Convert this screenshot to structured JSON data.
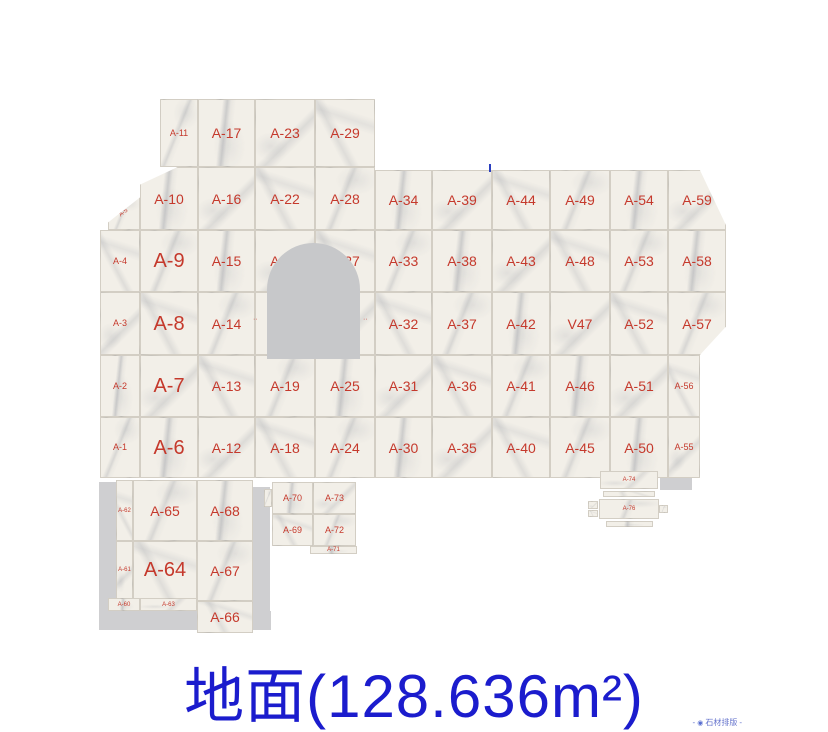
{
  "title": {
    "text": "地面(128.636m²)",
    "color": "#1b1ccd"
  },
  "watermark": {
    "dash_left": "-",
    "logo_icon": "◉",
    "text": "石材排版",
    "dash_right": "-"
  },
  "colors": {
    "label_red": "#c5392c",
    "title_blue": "#1b1ccd",
    "tile_base": "#f2efe8",
    "arch_gray": "#c7c8ca",
    "shadow_gray": "#cfcfd1"
  },
  "plan": {
    "tiles": [
      {
        "label": "A-11",
        "x": 160,
        "y": 99,
        "w": 38,
        "h": 68,
        "size": "sm"
      },
      {
        "label": "A-17",
        "x": 198,
        "y": 99,
        "w": 57,
        "h": 68
      },
      {
        "label": "A-23",
        "x": 255,
        "y": 99,
        "w": 60,
        "h": 68
      },
      {
        "label": "A-29",
        "x": 315,
        "y": 99,
        "w": 60,
        "h": 68
      },
      {
        "label": "A-5",
        "x": 108,
        "y": 196,
        "w": 32,
        "h": 34,
        "size": "xs",
        "rot": -38,
        "clip": "polygon(100% 4%,100% 100%,0 100%,0 78%)"
      },
      {
        "label": "A-10",
        "x": 140,
        "y": 167,
        "w": 58,
        "h": 63,
        "clip": "polygon(65% 0,100% 0,100% 100%,0 100%,0 28%)"
      },
      {
        "label": "A-16",
        "x": 198,
        "y": 167,
        "w": 57,
        "h": 63
      },
      {
        "label": "A-22",
        "x": 255,
        "y": 167,
        "w": 60,
        "h": 63
      },
      {
        "label": "A-28",
        "x": 315,
        "y": 167,
        "w": 60,
        "h": 63
      },
      {
        "label": "A-34",
        "x": 375,
        "y": 170,
        "w": 57,
        "h": 60
      },
      {
        "label": "A-39",
        "x": 432,
        "y": 170,
        "w": 60,
        "h": 60
      },
      {
        "label": "A-44",
        "x": 492,
        "y": 170,
        "w": 58,
        "h": 60
      },
      {
        "label": "A-49",
        "x": 550,
        "y": 170,
        "w": 60,
        "h": 60
      },
      {
        "label": "A-54",
        "x": 610,
        "y": 170,
        "w": 58,
        "h": 60
      },
      {
        "label": "A-59",
        "x": 668,
        "y": 170,
        "w": 58,
        "h": 60,
        "clip": "polygon(0 0,55% 0,100% 92%,100% 100%,0 100%)"
      },
      {
        "label": "A-4",
        "x": 100,
        "y": 230,
        "w": 40,
        "h": 62,
        "size": "sm"
      },
      {
        "label": "A-9",
        "x": 140,
        "y": 230,
        "w": 58,
        "h": 62,
        "size": "lg"
      },
      {
        "label": "A-15",
        "x": 198,
        "y": 230,
        "w": 57,
        "h": 62
      },
      {
        "label": "A-21",
        "x": 255,
        "y": 230,
        "w": 60,
        "h": 62
      },
      {
        "label": "A-27",
        "x": 315,
        "y": 230,
        "w": 60,
        "h": 62
      },
      {
        "label": "A-33",
        "x": 375,
        "y": 230,
        "w": 57,
        "h": 62
      },
      {
        "label": "A-38",
        "x": 432,
        "y": 230,
        "w": 60,
        "h": 62
      },
      {
        "label": "A-43",
        "x": 492,
        "y": 230,
        "w": 58,
        "h": 62
      },
      {
        "label": "A-48",
        "x": 550,
        "y": 230,
        "w": 60,
        "h": 62
      },
      {
        "label": "A-53",
        "x": 610,
        "y": 230,
        "w": 58,
        "h": 62
      },
      {
        "label": "A-58",
        "x": 668,
        "y": 230,
        "w": 58,
        "h": 62
      },
      {
        "label": "A-3",
        "x": 100,
        "y": 292,
        "w": 40,
        "h": 63,
        "size": "sm"
      },
      {
        "label": "A-8",
        "x": 140,
        "y": 292,
        "w": 58,
        "h": 63,
        "size": "lg"
      },
      {
        "label": "A-14",
        "x": 198,
        "y": 292,
        "w": 57,
        "h": 63
      },
      {
        "x": 255,
        "y": 292,
        "w": 60,
        "h": 63
      },
      {
        "x": 315,
        "y": 292,
        "w": 60,
        "h": 63
      },
      {
        "label": "A-32",
        "x": 375,
        "y": 292,
        "w": 57,
        "h": 63
      },
      {
        "label": "A-37",
        "x": 432,
        "y": 292,
        "w": 60,
        "h": 63
      },
      {
        "label": "A-42",
        "x": 492,
        "y": 292,
        "w": 58,
        "h": 63
      },
      {
        "label": "V47",
        "x": 550,
        "y": 292,
        "w": 60,
        "h": 63
      },
      {
        "label": "A-52",
        "x": 610,
        "y": 292,
        "w": 58,
        "h": 63
      },
      {
        "label": "A-57",
        "x": 668,
        "y": 292,
        "w": 58,
        "h": 63,
        "clip": "polygon(0 0,100% 0,100% 55%,55% 100%,0 100%)"
      },
      {
        "label": "A-2",
        "x": 100,
        "y": 355,
        "w": 40,
        "h": 62,
        "size": "sm"
      },
      {
        "label": "A-7",
        "x": 140,
        "y": 355,
        "w": 58,
        "h": 62,
        "size": "lg"
      },
      {
        "label": "A-13",
        "x": 198,
        "y": 355,
        "w": 57,
        "h": 62
      },
      {
        "label": "A-19",
        "x": 255,
        "y": 355,
        "w": 60,
        "h": 62
      },
      {
        "label": "A-25",
        "x": 315,
        "y": 355,
        "w": 60,
        "h": 62
      },
      {
        "label": "A-31",
        "x": 375,
        "y": 355,
        "w": 57,
        "h": 62
      },
      {
        "label": "A-36",
        "x": 432,
        "y": 355,
        "w": 60,
        "h": 62
      },
      {
        "label": "A-41",
        "x": 492,
        "y": 355,
        "w": 58,
        "h": 62
      },
      {
        "label": "A-46",
        "x": 550,
        "y": 355,
        "w": 60,
        "h": 62
      },
      {
        "label": "A-51",
        "x": 610,
        "y": 355,
        "w": 58,
        "h": 62
      },
      {
        "label": "A-56",
        "x": 668,
        "y": 355,
        "w": 32,
        "h": 62,
        "size": "sm"
      },
      {
        "label": "A-1",
        "x": 100,
        "y": 417,
        "w": 40,
        "h": 61,
        "size": "sm"
      },
      {
        "label": "A-6",
        "x": 140,
        "y": 417,
        "w": 58,
        "h": 61,
        "size": "lg"
      },
      {
        "label": "A-12",
        "x": 198,
        "y": 417,
        "w": 57,
        "h": 61
      },
      {
        "label": "A-18",
        "x": 255,
        "y": 417,
        "w": 60,
        "h": 61
      },
      {
        "label": "A-24",
        "x": 315,
        "y": 417,
        "w": 60,
        "h": 61
      },
      {
        "label": "A-30",
        "x": 375,
        "y": 417,
        "w": 57,
        "h": 61
      },
      {
        "label": "A-35",
        "x": 432,
        "y": 417,
        "w": 60,
        "h": 61
      },
      {
        "label": "A-40",
        "x": 492,
        "y": 417,
        "w": 58,
        "h": 61
      },
      {
        "label": "A-45",
        "x": 550,
        "y": 417,
        "w": 60,
        "h": 61
      },
      {
        "label": "A-50",
        "x": 610,
        "y": 417,
        "w": 58,
        "h": 61
      },
      {
        "label": "A-55",
        "x": 668,
        "y": 417,
        "w": 32,
        "h": 61,
        "size": "sm"
      },
      {
        "label": "A-62",
        "x": 116,
        "y": 480,
        "w": 17,
        "h": 61,
        "size": "xs"
      },
      {
        "label": "A-65",
        "x": 133,
        "y": 480,
        "w": 64,
        "h": 61
      },
      {
        "label": "A-68",
        "x": 197,
        "y": 480,
        "w": 56,
        "h": 61
      },
      {
        "label": "A-61",
        "x": 116,
        "y": 541,
        "w": 17,
        "h": 58,
        "size": "xs"
      },
      {
        "label": "A-64",
        "x": 133,
        "y": 541,
        "w": 64,
        "h": 58,
        "size": "lg"
      },
      {
        "label": "A-67",
        "x": 197,
        "y": 541,
        "w": 56,
        "h": 60
      },
      {
        "label": "A-60",
        "x": 108,
        "y": 598,
        "w": 32,
        "h": 13,
        "size": "xs"
      },
      {
        "label": "A-63",
        "x": 140,
        "y": 598,
        "w": 57,
        "h": 13,
        "size": "xs"
      },
      {
        "label": "A-66",
        "x": 197,
        "y": 601,
        "w": 56,
        "h": 32
      },
      {
        "x": 264,
        "y": 489,
        "w": 8,
        "h": 18
      },
      {
        "label": "A-70",
        "x": 272,
        "y": 482,
        "w": 41,
        "h": 32,
        "size": "sm"
      },
      {
        "label": "A-73",
        "x": 313,
        "y": 482,
        "w": 43,
        "h": 32,
        "size": "sm"
      },
      {
        "label": "A-69",
        "x": 272,
        "y": 514,
        "w": 41,
        "h": 32,
        "size": "sm"
      },
      {
        "label": "A-72",
        "x": 313,
        "y": 514,
        "w": 43,
        "h": 32,
        "size": "sm"
      },
      {
        "label": "A-71",
        "x": 310,
        "y": 546,
        "w": 47,
        "h": 8,
        "size": "xs"
      },
      {
        "label": "A-74",
        "x": 600,
        "y": 471,
        "w": 58,
        "h": 18,
        "size": "xs"
      },
      {
        "x": 603,
        "y": 491,
        "w": 52,
        "h": 6
      },
      {
        "label": "A-76",
        "x": 599,
        "y": 499,
        "w": 60,
        "h": 20,
        "size": "xs"
      },
      {
        "x": 606,
        "y": 521,
        "w": 47,
        "h": 6
      },
      {
        "x": 588,
        "y": 501,
        "w": 10,
        "h": 8
      },
      {
        "x": 588,
        "y": 510,
        "w": 10,
        "h": 7
      },
      {
        "x": 659,
        "y": 505,
        "w": 9,
        "h": 8
      }
    ],
    "shadows": [
      {
        "x": 99,
        "y": 482,
        "w": 17,
        "h": 148
      },
      {
        "x": 99,
        "y": 611,
        "w": 172,
        "h": 19
      },
      {
        "x": 253,
        "y": 487,
        "w": 17,
        "h": 131
      },
      {
        "x": 660,
        "y": 469,
        "w": 32,
        "h": 21
      }
    ],
    "arch_cutout": {
      "x": 267,
      "y": 243,
      "w": 93,
      "h": 116
    },
    "partial_marks": [
      {
        "text": "··",
        "x": 253,
        "y": 316
      },
      {
        "text": "··",
        "x": 363,
        "y": 316
      }
    ],
    "blue_tick": {
      "x": 489,
      "y": 164,
      "w": 2,
      "h": 8
    }
  }
}
